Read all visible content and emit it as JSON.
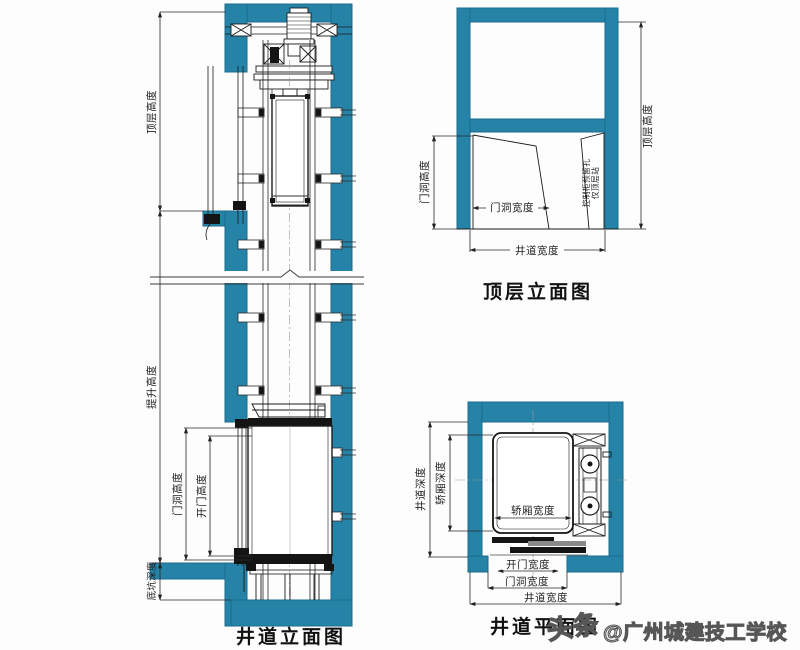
{
  "colors": {
    "wall_teal": "#2583a8",
    "wall_edge": "#1b6b8c",
    "line_art": "#1c1c1c",
    "watermark_gray": "#565656"
  },
  "elevation_view": {
    "title": "井道立面图",
    "dims": {
      "top_floor_height": "顶层高度",
      "travel_height": "提升高度",
      "pit_depth": "底坑深度",
      "door_opening_height": "门洞高度",
      "door_open_height": "开门高度"
    }
  },
  "top_floor_view": {
    "title": "顶层立面图",
    "dims": {
      "door_opening_height": "门洞高度",
      "door_opening_width": "门洞宽度",
      "shaft_width": "井道宽度",
      "top_floor_height": "顶层高度"
    },
    "note_line1": "控制柜预留孔",
    "note_line2": "仅顶层站"
  },
  "plan_view": {
    "title": "井道平面图",
    "dims": {
      "shaft_depth": "井道深度",
      "car_depth": "轿厢深度",
      "car_width": "轿厢宽度",
      "door_open_width": "开门宽度",
      "door_opening_width": "门洞宽度",
      "shaft_width": "井道宽度"
    }
  },
  "watermark": {
    "logo": "头条",
    "text": "@广州城建技工学校"
  }
}
